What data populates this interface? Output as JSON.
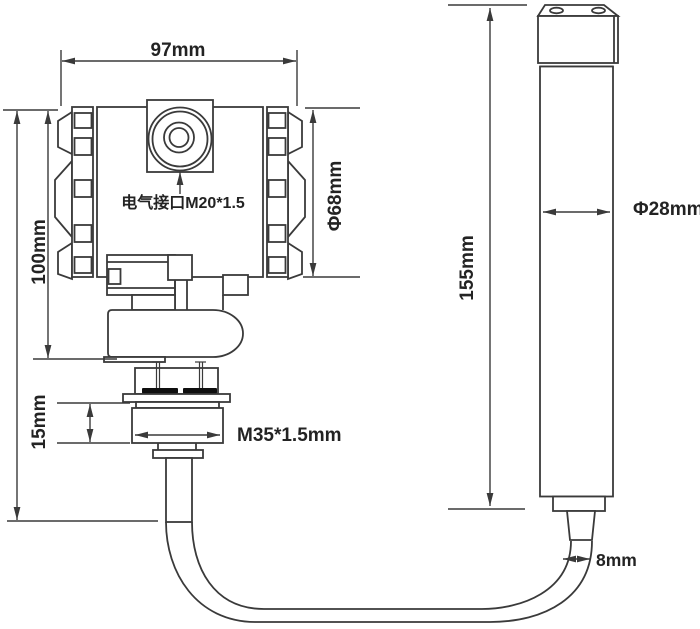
{
  "drawing": {
    "description": "Dimensional outline drawing of a pressure/level transmitter with remote submersible probe connected by cable",
    "colors": {
      "background": "#ffffff",
      "line": "#3a3a3a",
      "text": "#232323",
      "seal": "#0f0f0f"
    },
    "labels": {
      "top_width": "97mm",
      "housing_height": "100mm",
      "housing_diameter": "Φ68mm",
      "electrical_port": "电气接口M20*1.5",
      "thread_length": "15mm",
      "thread_spec": "M35*1.5mm",
      "probe_length": "155mm",
      "probe_diameter": "Φ28mm",
      "cable_diameter": "8mm"
    }
  }
}
